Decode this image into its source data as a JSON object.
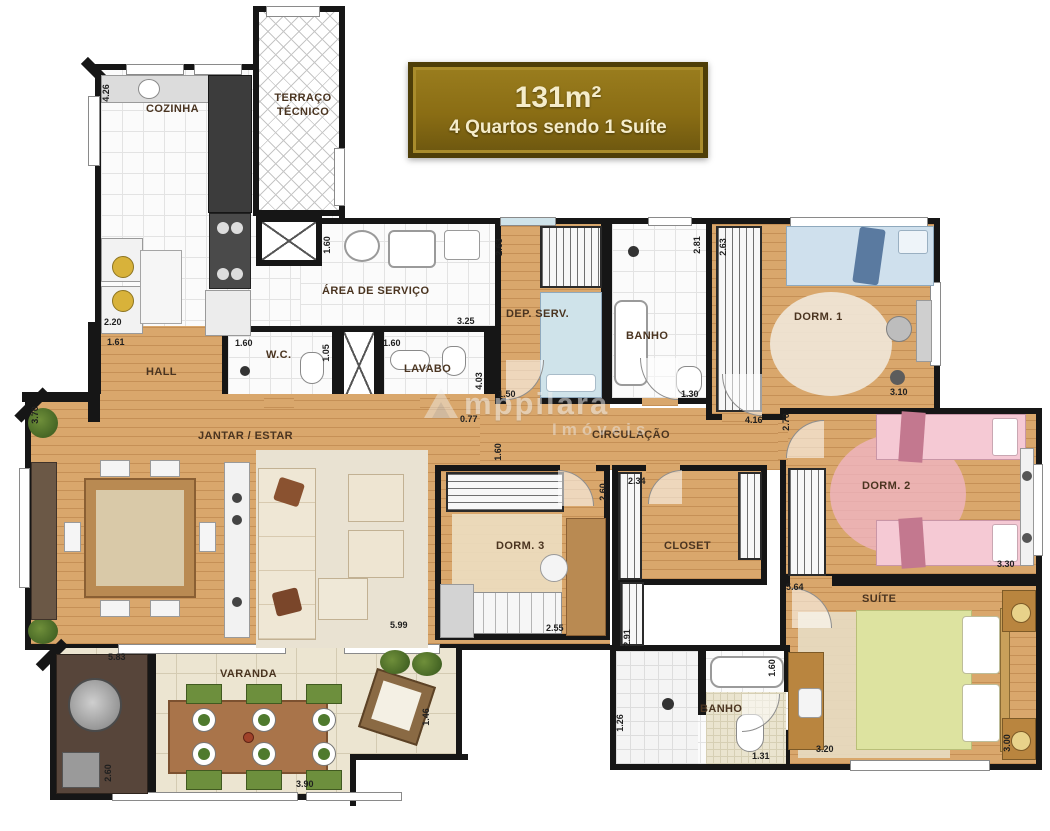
{
  "badge": {
    "area": "131m²",
    "subtitle": "4 Quartos sendo 1 Suíte"
  },
  "watermark": {
    "brand": "mppilara",
    "tagline": "Imóveis"
  },
  "colors": {
    "wall": "#161616",
    "wood_floor": "#d9a76c",
    "badge_gold": "#8a6d14",
    "badge_border": "#4e3e08",
    "badge_text": "#f5ecca",
    "bed_blue": "#cfe0ed",
    "bed_pink": "#f5c9d4",
    "bed_green": "#dde3a0",
    "chair_green": "#6d8f3d",
    "varanda_tile": "#ece5d1"
  },
  "rooms": [
    {
      "id": "cozinha",
      "label": "COZINHA",
      "x": 146,
      "y": 103
    },
    {
      "id": "terraco-tecnico",
      "label": "TERRAÇO TÉCNICO",
      "x": 266,
      "y": 92,
      "w": 74
    },
    {
      "id": "area-servico",
      "label": "ÁREA DE SERVIÇO",
      "x": 322,
      "y": 285
    },
    {
      "id": "hall",
      "label": "HALL",
      "x": 146,
      "y": 366
    },
    {
      "id": "wc",
      "label": "W.C.",
      "x": 266,
      "y": 349
    },
    {
      "id": "lavabo",
      "label": "LAVABO",
      "x": 404,
      "y": 363
    },
    {
      "id": "dep-serv",
      "label": "DEP. SERV.",
      "x": 506,
      "y": 308
    },
    {
      "id": "banho-social",
      "label": "BANHO",
      "x": 626,
      "y": 330
    },
    {
      "id": "dorm-1",
      "label": "DORM. 1",
      "x": 794,
      "y": 311
    },
    {
      "id": "jantar-estar",
      "label": "JANTAR / ESTAR",
      "x": 198,
      "y": 430
    },
    {
      "id": "circulacao",
      "label": "CIRCULAÇÃO",
      "x": 592,
      "y": 429
    },
    {
      "id": "dorm-2",
      "label": "DORM. 2",
      "x": 862,
      "y": 480
    },
    {
      "id": "dorm-3",
      "label": "DORM. 3",
      "x": 496,
      "y": 540
    },
    {
      "id": "closet",
      "label": "CLOSET",
      "x": 664,
      "y": 540
    },
    {
      "id": "suite",
      "label": "SUÍTE",
      "x": 862,
      "y": 593
    },
    {
      "id": "banho-suite",
      "label": "BANHO",
      "x": 700,
      "y": 703
    },
    {
      "id": "varanda",
      "label": "VARANDA",
      "x": 220,
      "y": 668
    }
  ],
  "dimensions": [
    {
      "label": "4.26",
      "x": 97,
      "y": 88,
      "v": true
    },
    {
      "label": "2.20",
      "x": 104,
      "y": 317,
      "v": false
    },
    {
      "label": "1.61",
      "x": 107,
      "y": 337,
      "v": false
    },
    {
      "label": "1.60",
      "x": 318,
      "y": 240,
      "v": true
    },
    {
      "label": "3.25",
      "x": 457,
      "y": 316,
      "v": false
    },
    {
      "label": "1.60",
      "x": 235,
      "y": 338,
      "v": false
    },
    {
      "label": "1.05",
      "x": 317,
      "y": 348,
      "v": true
    },
    {
      "label": "1.60",
      "x": 383,
      "y": 338,
      "v": false
    },
    {
      "label": "2.63",
      "x": 490,
      "y": 242,
      "v": true
    },
    {
      "label": "2.81",
      "x": 688,
      "y": 240,
      "v": true
    },
    {
      "label": "2.63",
      "x": 714,
      "y": 242,
      "v": true
    },
    {
      "label": "1.30",
      "x": 681,
      "y": 389,
      "v": false
    },
    {
      "label": "3.10",
      "x": 890,
      "y": 387,
      "v": false
    },
    {
      "label": "3.70",
      "x": 26,
      "y": 410,
      "v": true
    },
    {
      "label": "0.77",
      "x": 460,
      "y": 414,
      "v": false
    },
    {
      "label": "4.03",
      "x": 470,
      "y": 376,
      "v": true
    },
    {
      "label": "1.50",
      "x": 498,
      "y": 389,
      "v": false
    },
    {
      "label": "1.60",
      "x": 489,
      "y": 447,
      "v": true
    },
    {
      "label": "4.16",
      "x": 745,
      "y": 415,
      "v": false
    },
    {
      "label": "2.70",
      "x": 777,
      "y": 417,
      "v": true
    },
    {
      "label": "2.34",
      "x": 628,
      "y": 476,
      "v": false
    },
    {
      "label": "2.60",
      "x": 594,
      "y": 487,
      "v": true
    },
    {
      "label": "5.64",
      "x": 786,
      "y": 582,
      "v": false
    },
    {
      "label": "3.30",
      "x": 997,
      "y": 559,
      "v": false
    },
    {
      "label": "5.99",
      "x": 390,
      "y": 620,
      "v": false
    },
    {
      "label": "2.55",
      "x": 546,
      "y": 623,
      "v": false
    },
    {
      "label": "2.91",
      "x": 618,
      "y": 633,
      "v": true
    },
    {
      "label": "5.83",
      "x": 108,
      "y": 652,
      "v": false
    },
    {
      "label": "2.60",
      "x": 99,
      "y": 768,
      "v": true
    },
    {
      "label": "3.90",
      "x": 296,
      "y": 779,
      "v": false
    },
    {
      "label": "1.46",
      "x": 417,
      "y": 712,
      "v": true
    },
    {
      "label": "1.26",
      "x": 611,
      "y": 718,
      "v": true
    },
    {
      "label": "1.31",
      "x": 752,
      "y": 751,
      "v": false
    },
    {
      "label": "1.60",
      "x": 763,
      "y": 663,
      "v": true
    },
    {
      "label": "3.20",
      "x": 816,
      "y": 744,
      "v": false
    },
    {
      "label": "3.00",
      "x": 998,
      "y": 738,
      "v": true
    }
  ]
}
